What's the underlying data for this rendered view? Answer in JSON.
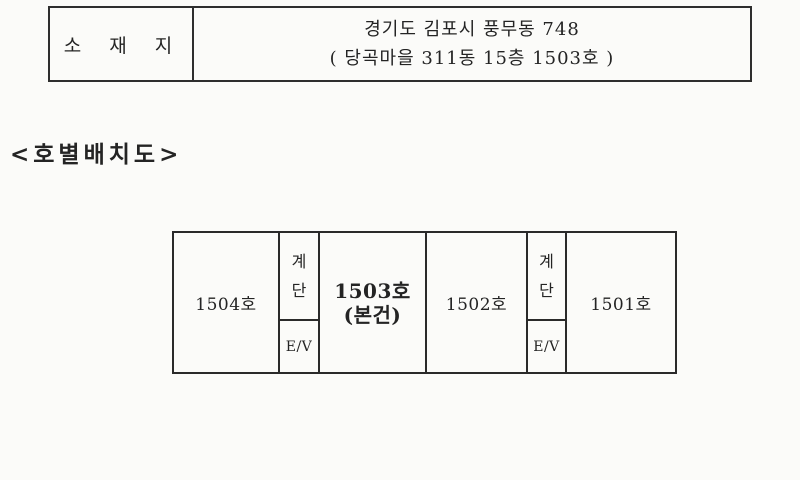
{
  "location_table": {
    "label": "소 재 지",
    "address_line1": "경기도 김포시 풍무동 748",
    "address_line2": "( 당곡마을 311동 15층 1503호 )"
  },
  "section_title": "<호별배치도>",
  "floor_plan": {
    "cells": [
      {
        "type": "unit",
        "label": "1504호"
      },
      {
        "type": "core",
        "stair_char1": "계",
        "stair_char2": "단",
        "elevator": "E/V"
      },
      {
        "type": "unit_subject",
        "label": "1503호",
        "note": "(본건)"
      },
      {
        "type": "unit",
        "label": "1502호"
      },
      {
        "type": "core",
        "stair_char1": "계",
        "stair_char2": "단",
        "elevator": "E/V"
      },
      {
        "type": "unit",
        "label": "1501호"
      }
    ]
  },
  "colors": {
    "ink": "#242424",
    "line": "#2a2a2a",
    "paper": "#fbfbf9"
  }
}
